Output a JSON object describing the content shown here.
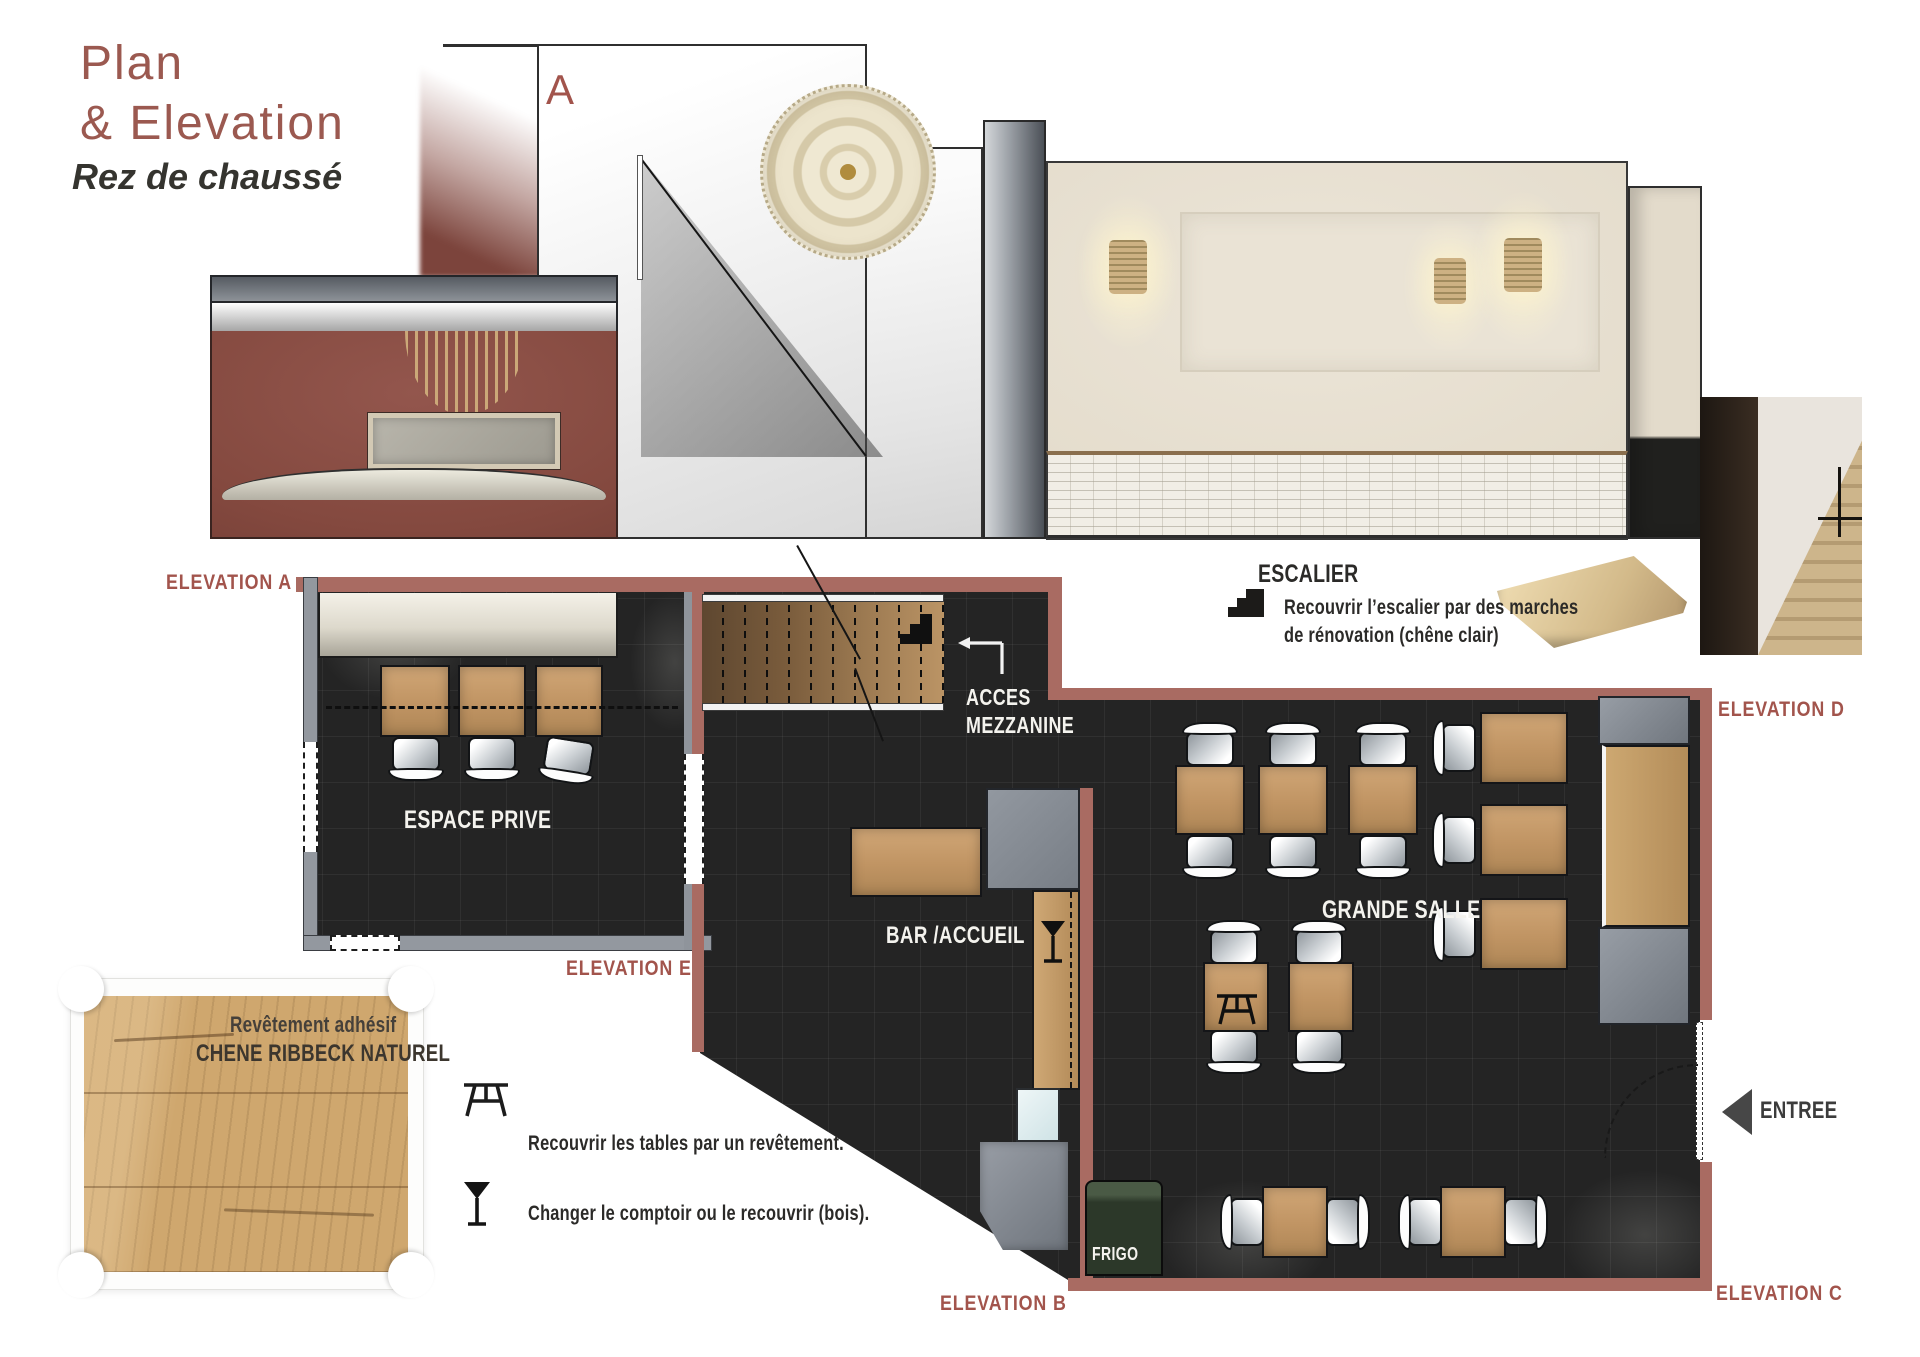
{
  "header": {
    "title_line1": "Plan",
    "title_line2": "& Elevation",
    "subtitle": "Rez de chaussé"
  },
  "elevation_view": {
    "marker": "A"
  },
  "stair_note": {
    "icon": "stairs-icon",
    "heading": "ESCALIER",
    "line1": "Recouvrir l’escalier par des marches",
    "line2": "de rénovation (chêne clair)"
  },
  "plan": {
    "labels": {
      "elevation_a": "ELEVATION A",
      "elevation_b": "ELEVATION B",
      "elevation_c": "ELEVATION C",
      "elevation_d": "ELEVATION D",
      "elevation_e": "ELEVATION E"
    },
    "rooms": {
      "espace_prive": "ESPACE PRIVE",
      "grande_salle": "GRANDE SALLE",
      "bar_accueil": "BAR /ACCUEIL",
      "frigo": "FRIGO",
      "acces_line1": "ACCES",
      "acces_line2": "MEZZANINE",
      "entree": "ENTREE"
    }
  },
  "legend": {
    "sample": {
      "line1": "Revêtement adhésif",
      "line2": "CHENE RIBBECK NATUREL"
    },
    "notes": [
      {
        "icon": "picnic-table-icon",
        "text": "Recouvrir les tables par un revêtement."
      },
      {
        "icon": "martini-glass-icon",
        "text": "Changer le comptoir ou le recouvrir (bois)."
      }
    ]
  },
  "colors": {
    "accent": "#a2544c",
    "wall_red": "#a96b62",
    "title": "#9b5950",
    "floor": "#242424",
    "wood": "#c79e6d",
    "gray_wall": "#8f949b",
    "beige_wall": "#e8e1d3",
    "frigo_green": "#2c3829",
    "ink": "#2b2a28"
  }
}
